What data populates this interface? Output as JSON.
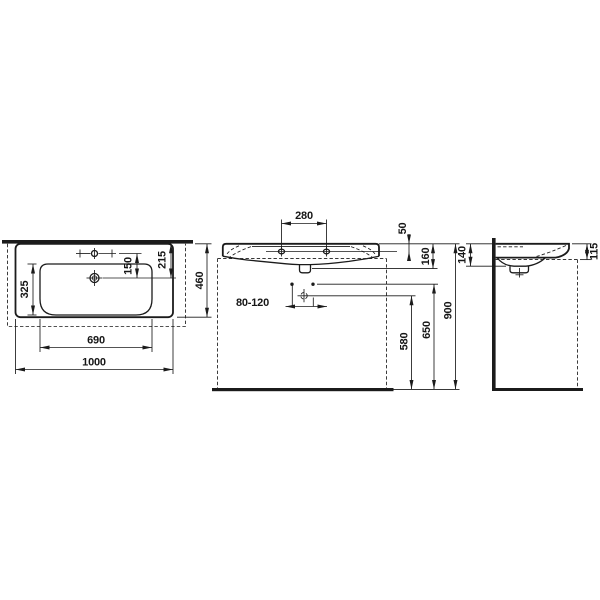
{
  "drawing": {
    "colors": {
      "line": "#1b1b1b",
      "background": "#ffffff"
    },
    "plan_view": {
      "dims": {
        "overall_width": "1000",
        "bowl_width": "690",
        "bowl_depth": "325",
        "taphole_to_drain": "150",
        "front_edge_to_drain": "215",
        "overall_depth": "460"
      }
    },
    "front_view": {
      "dims": {
        "fixing_hole_spacing": "280",
        "rim_to_fixing_holes": "50",
        "ceramic_height": "160",
        "drain_offset_range": "80-120",
        "floor_to_drain": "580",
        "floor_to_fixing_holes": "650",
        "floor_to_rim": "900"
      }
    },
    "side_view": {
      "dims": {
        "height_back": "140",
        "height_front": "115"
      }
    }
  }
}
